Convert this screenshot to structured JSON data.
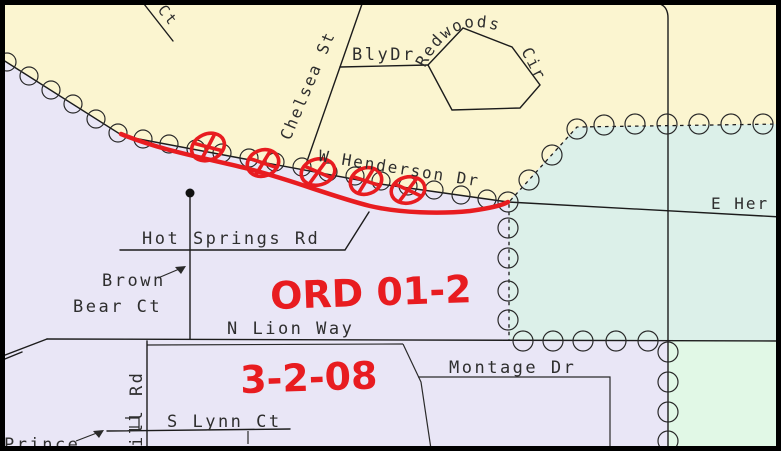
{
  "map": {
    "region_colors": {
      "north_parcel_zone": "#FBF5D0",
      "west_parcel_zone": "#E9E6F6",
      "east_annex_zone": "#DCF0E9",
      "southeast_zone": "#E1F8E6"
    },
    "ink_color": "#1c1c1c",
    "annotation_color": "#E81C20",
    "street_labels": {
      "ct": "Ct",
      "chelsea_st": "Chelsea St",
      "bly_dr": "BlyDr",
      "redwoods": "Redwoods",
      "cir": "Cir",
      "w_henderson_dr": "W Henderson Dr",
      "e_henderson_partial": "E Her",
      "hot_springs_rd": "Hot Springs Rd",
      "brown": "Brown",
      "bear_ct": "Bear Ct",
      "n_lion_way": "N Lion Way",
      "montage_dr": "Montage Dr",
      "s_lynn_ct": "S Lynn Ct",
      "ill_rd": "ill Rd",
      "prince_partial": "Prince"
    },
    "annotations": {
      "ordinance": "ORD 01-2",
      "date": "3-2-08",
      "crossed_circle_marker_count": "5"
    }
  }
}
